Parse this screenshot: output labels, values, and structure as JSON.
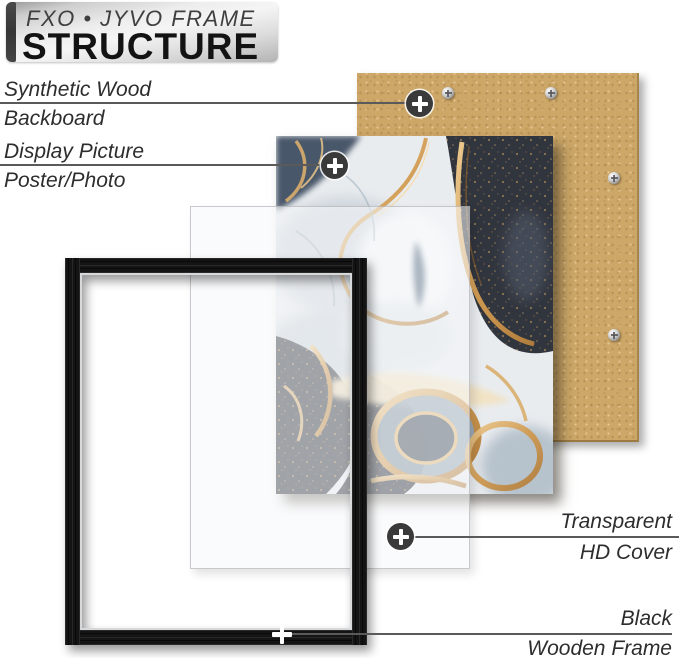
{
  "header": {
    "brand": "FXO • JYVO FRAME",
    "title": "STRUCTURE"
  },
  "callouts": {
    "backboard": {
      "line1": "Synthetic Wood",
      "line2": "Backboard"
    },
    "poster": {
      "line1": "Display Picture",
      "line2": "Poster/Photo"
    },
    "cover": {
      "line1": "Transparent",
      "line2": "HD Cover"
    },
    "frame": {
      "line1": "Black",
      "line2": "Wooden Frame"
    }
  },
  "colors": {
    "backboard_tan": "#cda768",
    "gold_accent": "#cf9a52",
    "frame_black": "#141414",
    "marble_dark": "#31353e",
    "marble_light": "#e9ecef",
    "label_text": "#2d2d2d",
    "leader_line": "#5a5a5a",
    "header_dark_bar": "#3d3d3d"
  }
}
